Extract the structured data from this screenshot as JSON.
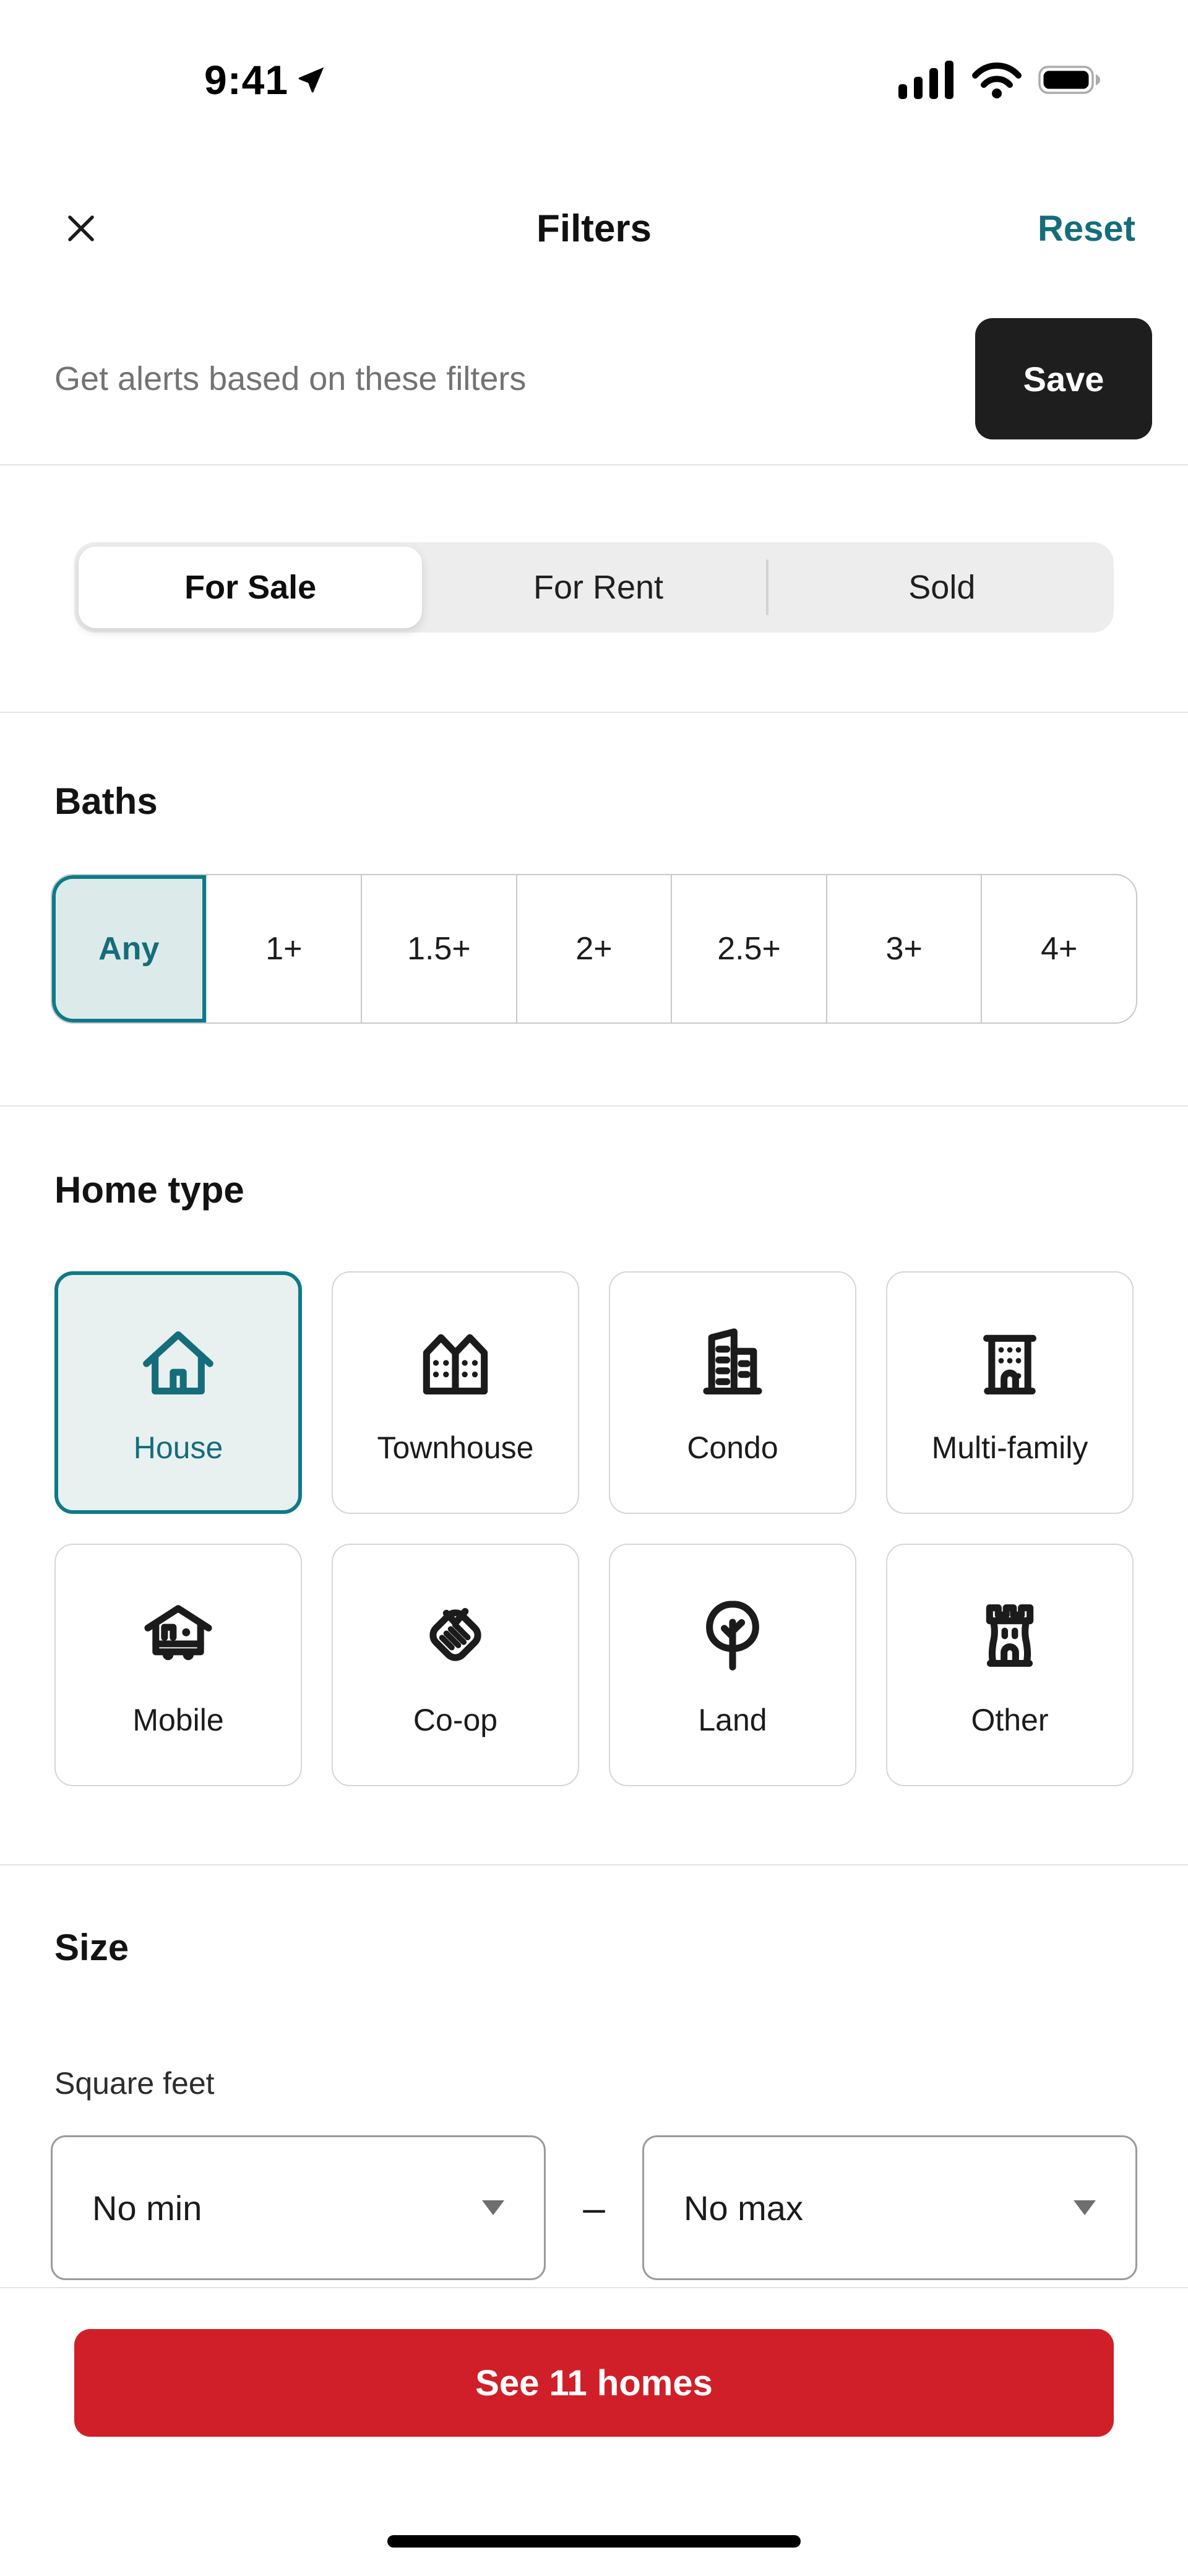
{
  "status_bar": {
    "time": "9:41"
  },
  "header": {
    "title": "Filters",
    "reset_label": "Reset"
  },
  "alert_bar": {
    "message": "Get alerts based on these filters",
    "save_label": "Save"
  },
  "listing_status": {
    "options": [
      {
        "label": "For Sale",
        "selected": true
      },
      {
        "label": "For Rent",
        "selected": false
      },
      {
        "label": "Sold",
        "selected": false
      }
    ]
  },
  "baths": {
    "title": "Baths",
    "options": [
      {
        "label": "Any",
        "selected": true
      },
      {
        "label": "1+",
        "selected": false
      },
      {
        "label": "1.5+",
        "selected": false
      },
      {
        "label": "2+",
        "selected": false
      },
      {
        "label": "2.5+",
        "selected": false
      },
      {
        "label": "3+",
        "selected": false
      },
      {
        "label": "4+",
        "selected": false
      }
    ]
  },
  "home_type": {
    "title": "Home type",
    "options": [
      {
        "label": "House",
        "icon": "house-icon",
        "selected": true
      },
      {
        "label": "Townhouse",
        "icon": "townhouse-icon",
        "selected": false
      },
      {
        "label": "Condo",
        "icon": "condo-icon",
        "selected": false
      },
      {
        "label": "Multi-family",
        "icon": "multi-family-icon",
        "selected": false
      },
      {
        "label": "Mobile",
        "icon": "mobile-home-icon",
        "selected": false
      },
      {
        "label": "Co-op",
        "icon": "co-op-icon",
        "selected": false
      },
      {
        "label": "Land",
        "icon": "land-icon",
        "selected": false
      },
      {
        "label": "Other",
        "icon": "other-icon",
        "selected": false
      }
    ]
  },
  "size": {
    "title": "Size",
    "field_label": "Square feet",
    "min_value": "No min",
    "max_value": "No max",
    "range_separator": "–"
  },
  "footer": {
    "cta_label": "See 11 homes"
  },
  "colors": {
    "accent_teal": "#0d7a89",
    "accent_teal_text": "#156d7b",
    "accent_teal_bg": "#dcebea",
    "cta_red": "#d01f28",
    "save_button_bg": "#1e1e1e"
  }
}
